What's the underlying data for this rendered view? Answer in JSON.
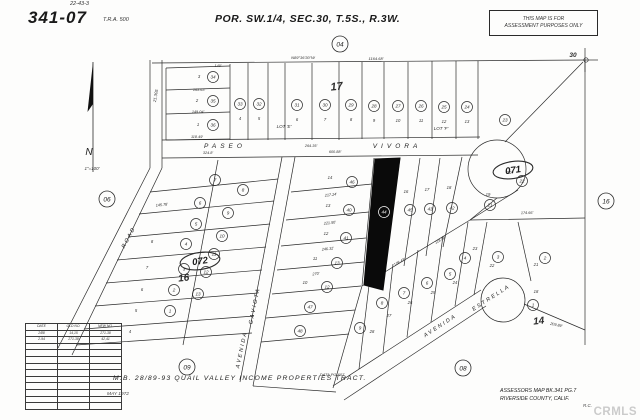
{
  "header": {
    "map_number": "341-07",
    "cross_ref": "22-43-3",
    "tra": "T.R.A. 500",
    "title": "POR. SW.1/4, SEC.30, T.5S., R.3W.",
    "disclaimer_line1": "THIS MAP IS FOR",
    "disclaimer_line2": "ASSESSMENT PURPOSES ONLY"
  },
  "footer": {
    "tract": "M.B. 28/89-93  QUAIL VALLEY INCOME PROPERTIES TRACT.",
    "date": "MAY 1972",
    "assessor_line1": "ASSESSORS MAP BK.341 PG.7",
    "assessor_line2": "RIVERSIDE COUNTY, CALIF.",
    "initials": "R.C.",
    "watermark": "CRMLS"
  },
  "compass": {
    "north_label": "N",
    "scale_label": "1\"=100'"
  },
  "correction_table": {
    "headers": [
      "DATE",
      "OLD NO.",
      "NEW NO."
    ],
    "rows": [
      [
        "2/88",
        "14,15",
        "271-38"
      ],
      [
        "2-94",
        "271-38",
        "42,41"
      ],
      [
        "",
        "",
        ""
      ],
      [
        "",
        "",
        ""
      ],
      [
        "",
        "",
        ""
      ],
      [
        "",
        "",
        ""
      ],
      [
        "",
        "",
        ""
      ],
      [
        "",
        "",
        ""
      ],
      [
        "",
        "",
        ""
      ],
      [
        "",
        "",
        ""
      ],
      [
        "",
        "",
        ""
      ],
      [
        "",
        "",
        ""
      ]
    ]
  },
  "map": {
    "line_color": "#2b2b2b",
    "highlight_color": "#0a0a0a",
    "segments": [
      [
        152,
        63,
        585,
        60
      ],
      [
        585,
        60,
        585,
        345
      ],
      [
        585,
        60,
        598,
        60
      ],
      [
        585,
        48,
        585,
        72
      ],
      [
        150,
        60,
        150,
        168
      ],
      [
        162,
        60,
        162,
        168
      ],
      [
        166,
        68,
        166,
        140
      ],
      [
        166,
        68,
        230,
        66
      ],
      [
        166,
        90,
        230,
        88
      ],
      [
        166,
        114,
        230,
        112
      ],
      [
        166,
        140,
        230,
        139
      ],
      [
        230,
        64,
        230,
        140
      ],
      [
        248,
        63,
        248,
        140
      ],
      [
        268,
        63,
        268,
        140
      ],
      [
        285,
        63,
        285,
        140
      ],
      [
        312,
        63,
        312,
        140
      ],
      [
        339,
        62,
        339,
        140
      ],
      [
        362,
        62,
        362,
        139
      ],
      [
        384,
        62,
        384,
        139
      ],
      [
        408,
        62,
        408,
        139
      ],
      [
        432,
        61,
        432,
        139
      ],
      [
        456,
        61,
        456,
        139
      ],
      [
        478,
        61,
        478,
        139
      ],
      [
        162,
        140,
        480,
        137
      ],
      [
        162,
        158,
        478,
        155
      ],
      [
        505,
        142,
        583,
        62
      ],
      [
        150,
        168,
        58,
        348
      ],
      [
        162,
        168,
        72,
        355
      ],
      [
        282,
        157,
        240,
        382
      ],
      [
        295,
        157,
        253,
        386
      ],
      [
        150,
        192,
        278,
        179
      ],
      [
        139,
        214,
        274,
        201
      ],
      [
        128,
        237,
        270,
        224
      ],
      [
        117,
        260,
        266,
        247
      ],
      [
        106,
        283,
        262,
        270
      ],
      [
        95,
        306,
        258,
        293
      ],
      [
        84,
        329,
        254,
        316
      ],
      [
        76,
        345,
        252,
        333
      ],
      [
        218,
        160,
        183,
        345
      ],
      [
        291,
        192,
        372,
        184
      ],
      [
        286,
        220,
        369,
        212
      ],
      [
        281,
        246,
        366,
        238
      ],
      [
        277,
        270,
        364,
        262
      ],
      [
        272,
        294,
        361,
        286
      ],
      [
        266,
        318,
        355,
        310
      ],
      [
        261,
        342,
        349,
        334
      ],
      [
        374,
        158,
        362,
        286
      ],
      [
        400,
        158,
        382,
        290
      ],
      [
        420,
        158,
        404,
        266
      ],
      [
        440,
        158,
        426,
        256
      ],
      [
        462,
        157,
        443,
        247
      ],
      [
        362,
        286,
        470,
        220
      ],
      [
        470,
        220,
        585,
        218
      ],
      [
        497,
        198,
        470,
        220
      ],
      [
        518,
        190,
        470,
        220
      ],
      [
        487,
        222,
        474,
        295
      ],
      [
        518,
        222,
        531,
        281
      ],
      [
        333,
        386,
        481,
        290
      ],
      [
        344,
        400,
        486,
        306
      ],
      [
        468,
        222,
        455,
        306
      ],
      [
        443,
        236,
        431,
        322
      ],
      [
        418,
        250,
        407,
        337
      ],
      [
        393,
        264,
        383,
        353
      ],
      [
        370,
        277,
        359,
        369
      ],
      [
        362,
        286,
        333,
        388
      ],
      [
        253,
        386,
        336,
        392
      ],
      [
        524,
        304,
        585,
        330
      ]
    ],
    "culdesacs": [
      {
        "x": 497,
        "y": 169,
        "r": 29
      },
      {
        "x": 503,
        "y": 300,
        "r": 22
      }
    ],
    "highlight_parcel": "375,159 400,158 383,290 364,285",
    "circled_numbers": [
      {
        "x": 213,
        "y": 77,
        "v": "34"
      },
      {
        "x": 213,
        "y": 101,
        "v": "35"
      },
      {
        "x": 213,
        "y": 125,
        "v": "36"
      },
      {
        "x": 240,
        "y": 104,
        "v": "33"
      },
      {
        "x": 259,
        "y": 104,
        "v": "32"
      },
      {
        "x": 297,
        "y": 105,
        "v": "31"
      },
      {
        "x": 325,
        "y": 105,
        "v": "30"
      },
      {
        "x": 351,
        "y": 105,
        "v": "29"
      },
      {
        "x": 374,
        "y": 106,
        "v": "28"
      },
      {
        "x": 398,
        "y": 106,
        "v": "27"
      },
      {
        "x": 421,
        "y": 106,
        "v": "26"
      },
      {
        "x": 444,
        "y": 107,
        "v": "25"
      },
      {
        "x": 467,
        "y": 107,
        "v": "24"
      },
      {
        "x": 505,
        "y": 120,
        "v": "23"
      },
      {
        "x": 522,
        "y": 181,
        "v": "22"
      },
      {
        "x": 490,
        "y": 205,
        "v": "21"
      },
      {
        "x": 545,
        "y": 258,
        "v": "2"
      },
      {
        "x": 498,
        "y": 257,
        "v": "3"
      },
      {
        "x": 533,
        "y": 305,
        "v": "1"
      },
      {
        "x": 465,
        "y": 258,
        "v": "4"
      },
      {
        "x": 450,
        "y": 274,
        "v": "5"
      },
      {
        "x": 427,
        "y": 283,
        "v": "6"
      },
      {
        "x": 404,
        "y": 293,
        "v": "7"
      },
      {
        "x": 382,
        "y": 303,
        "v": "8"
      },
      {
        "x": 360,
        "y": 328,
        "v": "9"
      },
      {
        "x": 352,
        "y": 182,
        "v": "46"
      },
      {
        "x": 349,
        "y": 210,
        "v": "40"
      },
      {
        "x": 346,
        "y": 238,
        "v": "41"
      },
      {
        "x": 337,
        "y": 263,
        "v": "13"
      },
      {
        "x": 327,
        "y": 287,
        "v": "12"
      },
      {
        "x": 384,
        "y": 212,
        "v": "44",
        "white": true
      },
      {
        "x": 410,
        "y": 210,
        "v": "45"
      },
      {
        "x": 430,
        "y": 209,
        "v": "43"
      },
      {
        "x": 452,
        "y": 208,
        "v": "42"
      },
      {
        "x": 215,
        "y": 180,
        "v": "7"
      },
      {
        "x": 200,
        "y": 203,
        "v": "6"
      },
      {
        "x": 196,
        "y": 224,
        "v": "5"
      },
      {
        "x": 186,
        "y": 244,
        "v": "4"
      },
      {
        "x": 184,
        "y": 269,
        "v": "3"
      },
      {
        "x": 174,
        "y": 290,
        "v": "2"
      },
      {
        "x": 170,
        "y": 311,
        "v": "1"
      },
      {
        "x": 243,
        "y": 190,
        "v": "8"
      },
      {
        "x": 228,
        "y": 213,
        "v": "9"
      },
      {
        "x": 222,
        "y": 236,
        "v": "10"
      },
      {
        "x": 214,
        "y": 254,
        "v": "11"
      },
      {
        "x": 206,
        "y": 272,
        "v": "12"
      },
      {
        "x": 198,
        "y": 294,
        "v": "13"
      },
      {
        "x": 310,
        "y": 307,
        "v": "47"
      },
      {
        "x": 300,
        "y": 331,
        "v": "48"
      }
    ],
    "lot_numbers": [
      {
        "x": 199,
        "y": 78,
        "t": "3"
      },
      {
        "x": 197,
        "y": 102,
        "t": "2"
      },
      {
        "x": 198,
        "y": 126,
        "t": "1"
      },
      {
        "x": 240,
        "y": 120,
        "t": "4"
      },
      {
        "x": 259,
        "y": 120,
        "t": "5"
      },
      {
        "x": 297,
        "y": 121,
        "t": "6"
      },
      {
        "x": 325,
        "y": 121,
        "t": "7"
      },
      {
        "x": 351,
        "y": 121,
        "t": "8"
      },
      {
        "x": 374,
        "y": 122,
        "t": "9"
      },
      {
        "x": 398,
        "y": 122,
        "t": "10"
      },
      {
        "x": 421,
        "y": 122,
        "t": "11"
      },
      {
        "x": 444,
        "y": 123,
        "t": "12"
      },
      {
        "x": 467,
        "y": 123,
        "t": "13"
      },
      {
        "x": 509,
        "y": 174,
        "t": "20"
      },
      {
        "x": 488,
        "y": 196,
        "t": "19"
      },
      {
        "x": 492,
        "y": 267,
        "t": "22"
      },
      {
        "x": 536,
        "y": 266,
        "t": "21"
      },
      {
        "x": 536,
        "y": 293,
        "t": "18"
      },
      {
        "x": 475,
        "y": 250,
        "t": "23"
      },
      {
        "x": 455,
        "y": 284,
        "t": "24"
      },
      {
        "x": 433,
        "y": 294,
        "t": "25"
      },
      {
        "x": 410,
        "y": 304,
        "t": "26"
      },
      {
        "x": 389,
        "y": 317,
        "t": "27"
      },
      {
        "x": 372,
        "y": 333,
        "t": "28"
      },
      {
        "x": 330,
        "y": 179,
        "t": "14"
      },
      {
        "x": 328,
        "y": 207,
        "t": "13"
      },
      {
        "x": 326,
        "y": 235,
        "t": "12"
      },
      {
        "x": 315,
        "y": 260,
        "t": "11"
      },
      {
        "x": 305,
        "y": 284,
        "t": "10"
      },
      {
        "x": 406,
        "y": 193,
        "t": "16"
      },
      {
        "x": 427,
        "y": 191,
        "t": "17"
      },
      {
        "x": 449,
        "y": 189,
        "t": "18"
      },
      {
        "x": 152,
        "y": 243,
        "t": "8"
      },
      {
        "x": 147,
        "y": 269,
        "t": "7"
      },
      {
        "x": 142,
        "y": 291,
        "t": "6"
      },
      {
        "x": 136,
        "y": 312,
        "t": "5"
      },
      {
        "x": 130,
        "y": 333,
        "t": "4"
      }
    ],
    "street_labels": [
      {
        "t": "PASEO",
        "x": 225,
        "y": 148,
        "s": 6.5,
        "r": 0,
        "ls": 4
      },
      {
        "t": "VIVORA",
        "x": 397,
        "y": 148,
        "s": 6.5,
        "r": 0,
        "ls": 4
      },
      {
        "t": "AVENIDA",
        "x": 243,
        "y": 350,
        "s": 5.5,
        "r": -78,
        "ls": 2
      },
      {
        "t": "GAVIOTA",
        "x": 256,
        "y": 306,
        "s": 5.5,
        "r": -78,
        "ls": 2
      },
      {
        "t": "AVENIDA",
        "x": 441,
        "y": 327,
        "s": 5.5,
        "r": -33,
        "ls": 2
      },
      {
        "t": "ESTRELLA",
        "x": 492,
        "y": 299,
        "s": 5.5,
        "r": -33,
        "ls": 2
      },
      {
        "t": "ROAD",
        "x": 130,
        "y": 238,
        "s": 5.5,
        "r": -62,
        "ls": 2
      }
    ],
    "annotations": [
      {
        "t": "17",
        "x": 337,
        "y": 90,
        "s": 11,
        "r": -6,
        "b": true
      },
      {
        "t": "16",
        "x": 184,
        "y": 281,
        "s": 10,
        "r": -6,
        "b": true
      },
      {
        "t": "14",
        "x": 539,
        "y": 324,
        "s": 10,
        "r": -6,
        "b": true
      },
      {
        "t": "30",
        "x": 573,
        "y": 57,
        "s": 6.5,
        "r": 0,
        "b": true
      },
      {
        "t": "LOT 'E'",
        "x": 284,
        "y": 128,
        "s": 4.5,
        "r": 0
      },
      {
        "t": "LOT 'F'",
        "x": 441,
        "y": 130,
        "s": 4.5,
        "r": 0
      },
      {
        "t": "N89°36'30\"W",
        "x": 303,
        "y": 59,
        "s": 4,
        "r": 0
      },
      {
        "t": "1164.68'",
        "x": 376,
        "y": 60,
        "s": 4,
        "r": 0
      },
      {
        "t": "264.35'",
        "x": 311,
        "y": 147,
        "s": 3.8,
        "r": 0
      },
      {
        "t": "600.88'",
        "x": 335,
        "y": 153,
        "s": 3.8,
        "r": 0
      },
      {
        "t": "324.8'",
        "x": 208,
        "y": 154,
        "s": 3.8,
        "r": 0
      },
      {
        "t": "140'",
        "x": 218,
        "y": 67,
        "s": 3.8,
        "r": 0
      },
      {
        "t": "163.63'",
        "x": 199,
        "y": 91,
        "s": 3.8,
        "r": 0
      },
      {
        "t": "149.04'",
        "x": 198,
        "y": 113,
        "s": 3.8,
        "r": 0
      },
      {
        "t": "118.49'",
        "x": 197,
        "y": 138,
        "s": 3.8,
        "r": 0
      },
      {
        "t": "21.305",
        "x": 157,
        "y": 96,
        "s": 4.2,
        "r": -80
      },
      {
        "t": "145.78'",
        "x": 162,
        "y": 206,
        "s": 3.8,
        "r": -6
      },
      {
        "t": "217.24'",
        "x": 331,
        "y": 196,
        "s": 3.8,
        "r": -6
      },
      {
        "t": "221.50'",
        "x": 330,
        "y": 224,
        "s": 3.8,
        "r": -6
      },
      {
        "t": "246.32'",
        "x": 328,
        "y": 250,
        "s": 3.8,
        "r": -6
      },
      {
        "t": "270'",
        "x": 316,
        "y": 275,
        "s": 3.8,
        "r": -6
      },
      {
        "t": "108.43'",
        "x": 400,
        "y": 263,
        "s": 3.8,
        "r": -29
      },
      {
        "t": "118.84'",
        "x": 441,
        "y": 241,
        "s": 3.8,
        "r": -29
      },
      {
        "t": "174.66'",
        "x": 527,
        "y": 214,
        "s": 3.8,
        "r": -1
      },
      {
        "t": "209.89'",
        "x": 556,
        "y": 326,
        "s": 3.8,
        "r": 12
      },
      {
        "t": "DATA  PG 607",
        "x": 332,
        "y": 376,
        "s": 4,
        "r": 0
      }
    ],
    "ref_circles": [
      {
        "t": "04",
        "x": 340,
        "y": 44
      },
      {
        "t": "06",
        "x": 107,
        "y": 199
      },
      {
        "t": "09",
        "x": 187,
        "y": 367
      },
      {
        "t": "08",
        "x": 463,
        "y": 368
      },
      {
        "t": "16",
        "x": 606,
        "y": 201
      }
    ],
    "block_ovals": [
      {
        "t": "071",
        "x": 513,
        "y": 170
      },
      {
        "t": "072",
        "x": 200,
        "y": 261
      }
    ]
  }
}
